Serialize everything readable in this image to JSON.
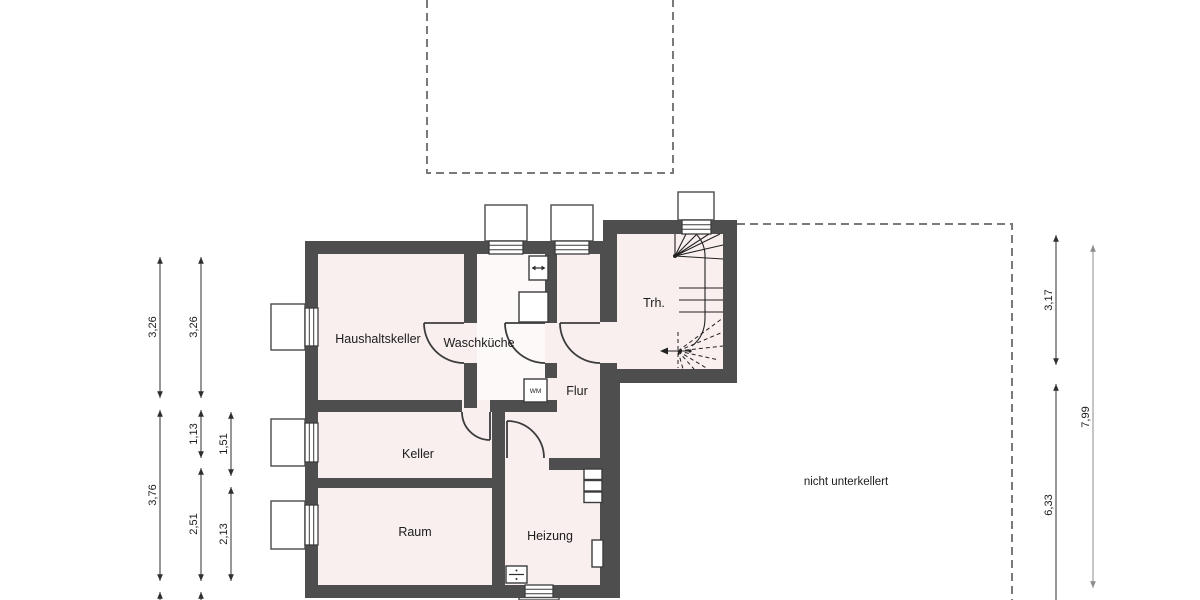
{
  "rooms": {
    "haushaltskeller": "Haushaltskeller",
    "waschkueche": "Waschküche",
    "flur": "Flur",
    "keller": "Keller",
    "raum": "Raum",
    "heizung": "Heizung",
    "treppenhaus": "Trh."
  },
  "annotations": {
    "not_excavated": "nicht unterkellert",
    "washing_machine": "WM"
  },
  "dimensions": {
    "left": [
      "3,26",
      "3,26",
      "3,76",
      "1,13",
      "2,51",
      "1,51",
      "2,13"
    ],
    "right": [
      "3,17",
      "6,33",
      "7,99"
    ]
  },
  "colors": {
    "wall": "#4e4e4e",
    "room_fill": "#f9efef",
    "waschkueche_fill": "#fdf9f9",
    "dashed_outline": "#7a7a7a",
    "dimension_line": "#2f2f2f"
  }
}
